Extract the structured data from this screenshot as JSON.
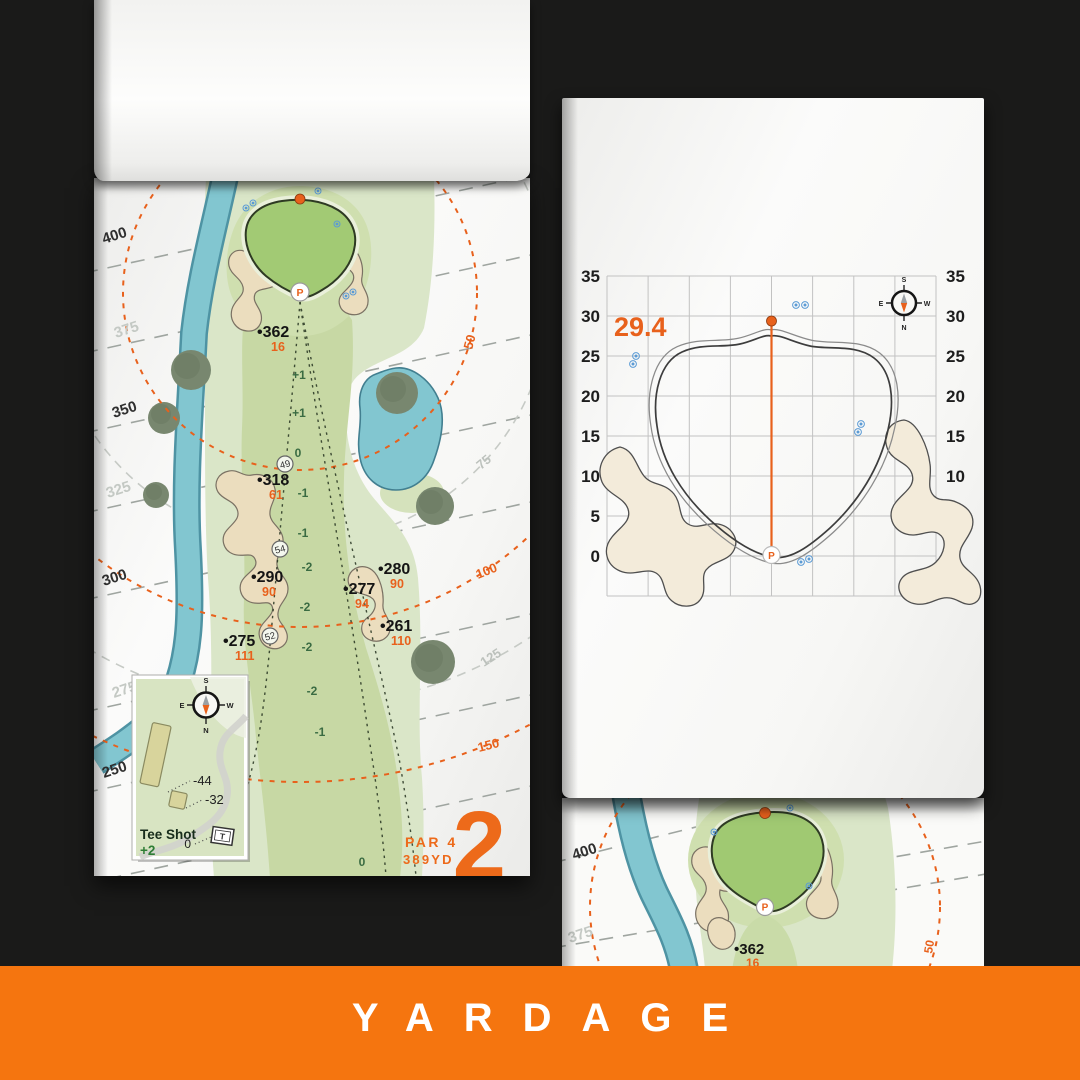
{
  "banner": {
    "title": "YARDAGE"
  },
  "colors": {
    "accent_orange": "#E8611C",
    "banner_orange": "#F5750F",
    "water": "#82C6D0",
    "putting_green": "#A2CA74",
    "fairway": "#C7D8A4",
    "rough": "#DAE6C8",
    "bunker": "#EBDDBE",
    "paper": "#FAFAF8",
    "background": "#1A1A19"
  },
  "compass": {
    "n": "N",
    "s": "S",
    "e": "E",
    "w": "W"
  },
  "hole_page": {
    "hole_number": "2",
    "par_label": "PAR 4",
    "yardage_label": "389YD",
    "distance_bands": [
      {
        "label": "400",
        "emphasis": "dark"
      },
      {
        "label": "375",
        "emphasis": "light"
      },
      {
        "label": "350",
        "emphasis": "dark"
      },
      {
        "label": "325",
        "emphasis": "light"
      },
      {
        "label": "300",
        "emphasis": "dark"
      },
      {
        "label": "275",
        "emphasis": "light"
      },
      {
        "label": "250",
        "emphasis": "dark"
      }
    ],
    "arc_labels": [
      {
        "label": "50",
        "color": "orange"
      },
      {
        "label": "75",
        "color": "gray"
      },
      {
        "label": "100",
        "color": "orange"
      },
      {
        "label": "125",
        "color": "gray"
      },
      {
        "label": "150",
        "color": "orange"
      }
    ],
    "yardage_markers": [
      {
        "distance": "•362",
        "carry": "16"
      },
      {
        "distance": "•318",
        "carry": "61"
      },
      {
        "distance": "•290",
        "carry": "90"
      },
      {
        "distance": "•280",
        "carry": "90"
      },
      {
        "distance": "•277",
        "carry": "94"
      },
      {
        "distance": "•261",
        "carry": "110"
      },
      {
        "distance": "•275",
        "carry": "111"
      }
    ],
    "elevation_marks": [
      "+1",
      "+1",
      "0",
      "-1",
      "-1",
      "-2",
      "-2",
      "-2",
      "-2",
      "-1",
      "0"
    ],
    "circled_numbers": [
      "49",
      "54",
      "52"
    ],
    "pin_symbol": "P",
    "tee_inset": {
      "title": "Tee Shot",
      "elevation": "+2",
      "offsets": [
        "-44",
        "-32",
        "0"
      ],
      "tee_marker": "T"
    }
  },
  "green_page": {
    "depth_value": "29.4",
    "axis_ticks": [
      "35",
      "30",
      "25",
      "20",
      "15",
      "10",
      "5",
      "0"
    ],
    "pin_symbol": "P"
  },
  "preview_page": {
    "distance_bands": [
      {
        "label": "400"
      },
      {
        "label": "375"
      }
    ],
    "marker": {
      "distance": "•362",
      "carry": "16"
    },
    "arc_label": "50"
  }
}
